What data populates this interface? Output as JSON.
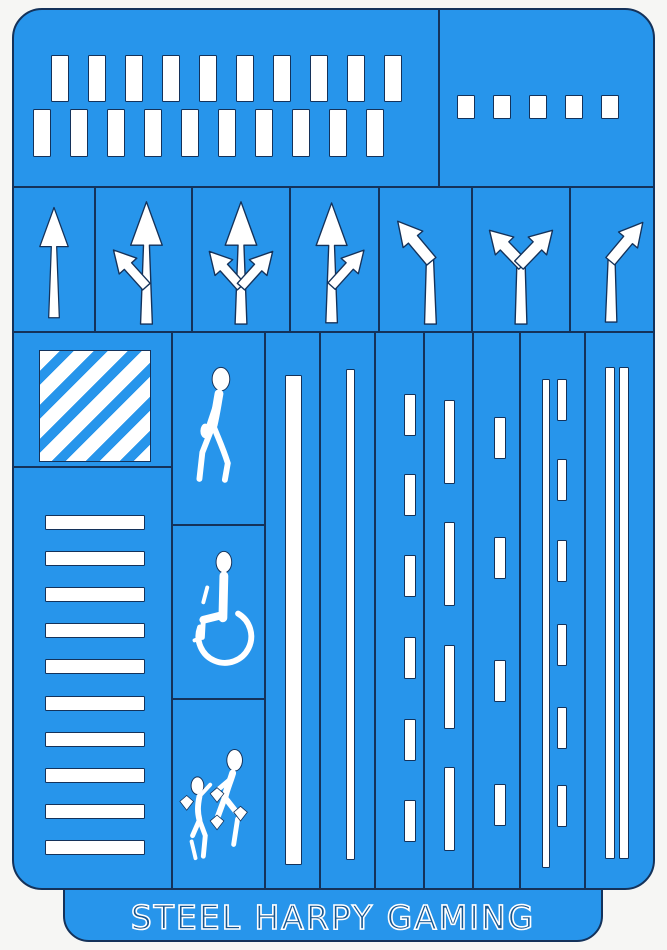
{
  "colors": {
    "sheet_blue": "#2795EB",
    "outline_dark": "#14325A",
    "cut_white": "#FFFFFF",
    "background": "#F6F6F4"
  },
  "brand": {
    "text": "STEEL HARPY GAMING"
  },
  "panels": {
    "crosswalk_large": {
      "label": "large crosswalk bars",
      "row1_count": 10,
      "row2_count": 10
    },
    "dash_small": {
      "label": "small dash squares",
      "count": 5
    },
    "arrows": [
      {
        "id": "arrow-straight"
      },
      {
        "id": "arrow-straight-left"
      },
      {
        "id": "arrow-straight-left-right"
      },
      {
        "id": "arrow-straight-right"
      },
      {
        "id": "arrow-turn-left"
      },
      {
        "id": "arrow-turn-left-right"
      },
      {
        "id": "arrow-turn-right"
      }
    ],
    "diagonal_hatch": {
      "label": "diagonal hatch square",
      "stripe_count": 6
    },
    "zebra": {
      "label": "zebra crossing bars",
      "bar_count": 10
    },
    "pedestrians": [
      {
        "id": "pedestrian-walking"
      },
      {
        "id": "pedestrian-wheelchair"
      },
      {
        "id": "pedestrian-children"
      }
    ],
    "line_columns": [
      {
        "id": "line-solid-wide",
        "style": "solid",
        "line_count": 1
      },
      {
        "id": "line-solid-thin",
        "style": "solid",
        "line_count": 1
      },
      {
        "id": "line-dashed-medium",
        "style": "dashed",
        "dash_count": 6
      },
      {
        "id": "line-dashed-long",
        "style": "dashed",
        "dash_count": 4
      },
      {
        "id": "line-dashed-sparse",
        "style": "dashed",
        "dash_count": 4
      },
      {
        "id": "line-solid-and-dashed",
        "style": "combo",
        "line_count": 1,
        "dash_count": 6
      },
      {
        "id": "line-double-solid",
        "style": "double",
        "line_count": 2
      }
    ]
  }
}
